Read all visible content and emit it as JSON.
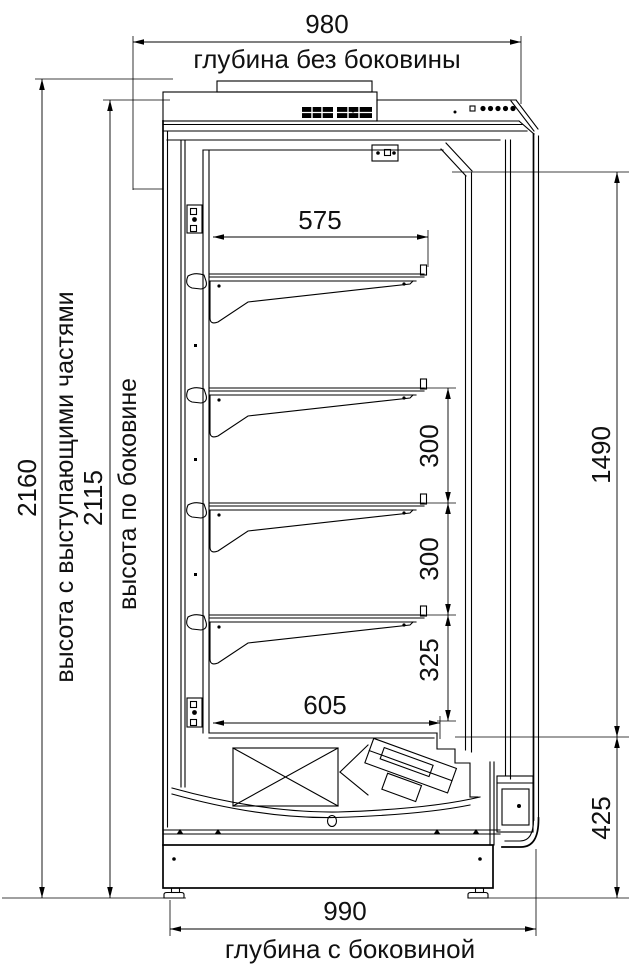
{
  "drawing": {
    "dimensions": {
      "depth_top": {
        "value": "980",
        "label": "глубина без боковины"
      },
      "height_overall": {
        "value": "2160",
        "label": "высота с выступающими частями"
      },
      "height_side": {
        "value": "2115",
        "label": "высота по боковине"
      },
      "shelf_width": {
        "value": "575"
      },
      "shelf_gap_1": {
        "value": "300"
      },
      "shelf_gap_2": {
        "value": "300"
      },
      "shelf_gap_3": {
        "value": "325"
      },
      "deck_width": {
        "value": "605"
      },
      "interior_height": {
        "value": "1490"
      },
      "base_height": {
        "value": "425"
      },
      "depth_bottom": {
        "value": "990",
        "label": "глубина с боковиной"
      }
    }
  }
}
